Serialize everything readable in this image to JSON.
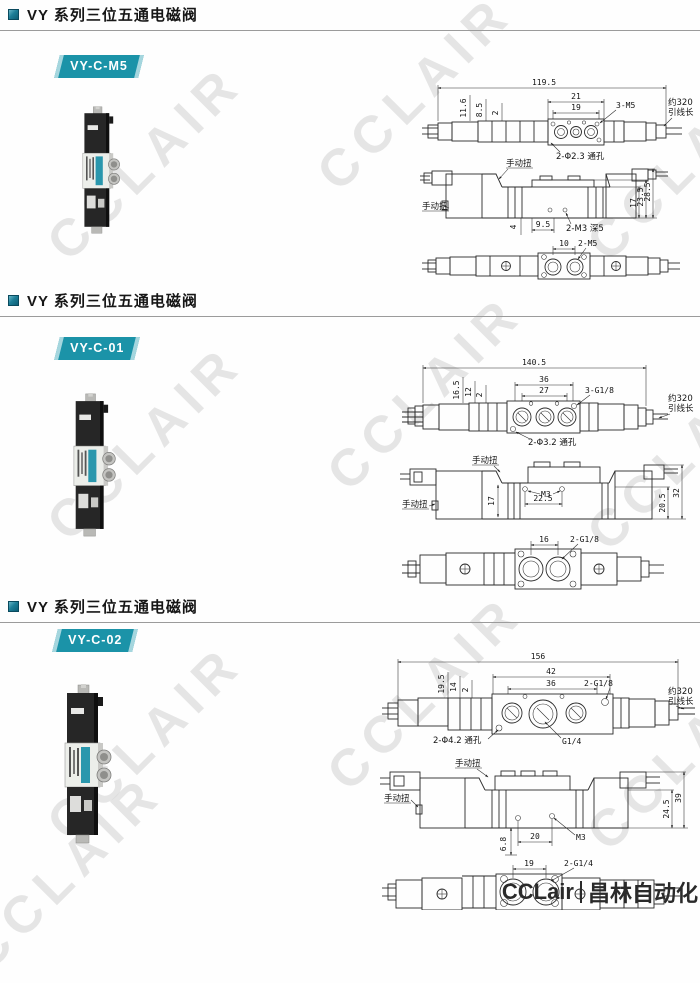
{
  "page": {
    "watermark": "CCLAIR",
    "footer": {
      "brand": "CCLair",
      "company": "昌林自动化"
    }
  },
  "sections": [
    {
      "title": "VY 系列三位五通电磁阀",
      "model": "VY-C-M5",
      "drawing": {
        "overall_length": "119.5",
        "width_outer": "21",
        "width_inner": "19",
        "offset1": "11.6",
        "offset2": "8.5",
        "offset3": "2",
        "port_label": "3-M5",
        "hole_label": "2-Φ2.3 通孔",
        "lead_note1": "约320",
        "lead_note2": "引线长",
        "manual_label": "手动扭",
        "side_dim1": "4",
        "side_dim2": "9.5",
        "side_thread": "2-M3 深5",
        "height1": "17",
        "height2": "23.5",
        "height3": "28.5",
        "bottom_pitch": "10",
        "bottom_port": "2-M5"
      }
    },
    {
      "title": "VY 系列三位五通电磁阀",
      "model": "VY-C-01",
      "drawing": {
        "overall_length": "140.5",
        "width_outer": "36",
        "width_inner": "27",
        "offset1": "16.5",
        "offset2": "12",
        "offset3": "2",
        "port_label": "3-G1/8",
        "hole_label": "2-Φ3.2 通孔",
        "lead_note1": "约320",
        "lead_note2": "引线长",
        "manual_label": "手动扭",
        "side_dim1": "17",
        "side_dim2": "22.5",
        "side_thread": "M3",
        "height1": "20.5",
        "height2": "32",
        "bottom_pitch": "16",
        "bottom_port": "2-G1/8"
      }
    },
    {
      "title": "VY 系列三位五通电磁阀",
      "model": "VY-C-02",
      "drawing": {
        "overall_length": "156",
        "width_outer": "42",
        "width_inner": "36",
        "offset1": "19.5",
        "offset2": "14",
        "offset3": "2",
        "port_label": "2-G1/8",
        "center_port": "G1/4",
        "hole_label": "2-Φ4.2 通孔",
        "lead_note1": "约320",
        "lead_note2": "引线长",
        "manual_label": "手动扭",
        "side_dim1": "6.8",
        "side_dim2": "20",
        "side_thread": "M3",
        "height1": "24.5",
        "height2": "39",
        "bottom_pitch": "19",
        "bottom_port": "2-G1/4"
      }
    }
  ]
}
